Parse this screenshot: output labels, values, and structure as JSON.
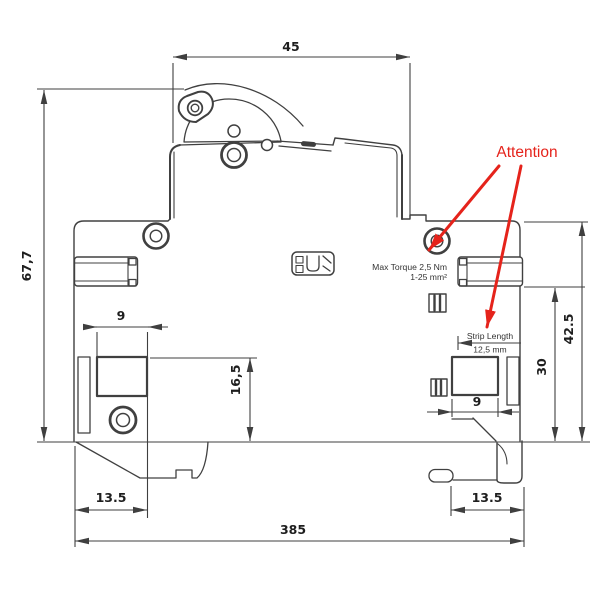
{
  "drawing": {
    "description": "Side-view dimensional drawing of a DIN-rail miniature circuit breaker",
    "dims": {
      "width_top": "45",
      "height_overall": "67,7",
      "opening_left_width": "9",
      "opening_left_height": "16,5",
      "foot_left": "13.5",
      "depth_overall": "385",
      "right_height_upper": "42.5",
      "right_height_lower": "30",
      "opening_right_width": "9",
      "foot_right": "13.5"
    },
    "annotations": {
      "attention": "Attention",
      "max_torque": "Max Torque 2,5 Nm",
      "wire_range": "1-25 mm²",
      "strip_length_label": "Strip Length",
      "strip_length_value": "12,5 mm"
    },
    "colors": {
      "drawing_line": "#404040",
      "dimension_text": "#1e1e1e",
      "attention_red": "#e5231b",
      "background": "#ffffff"
    }
  }
}
